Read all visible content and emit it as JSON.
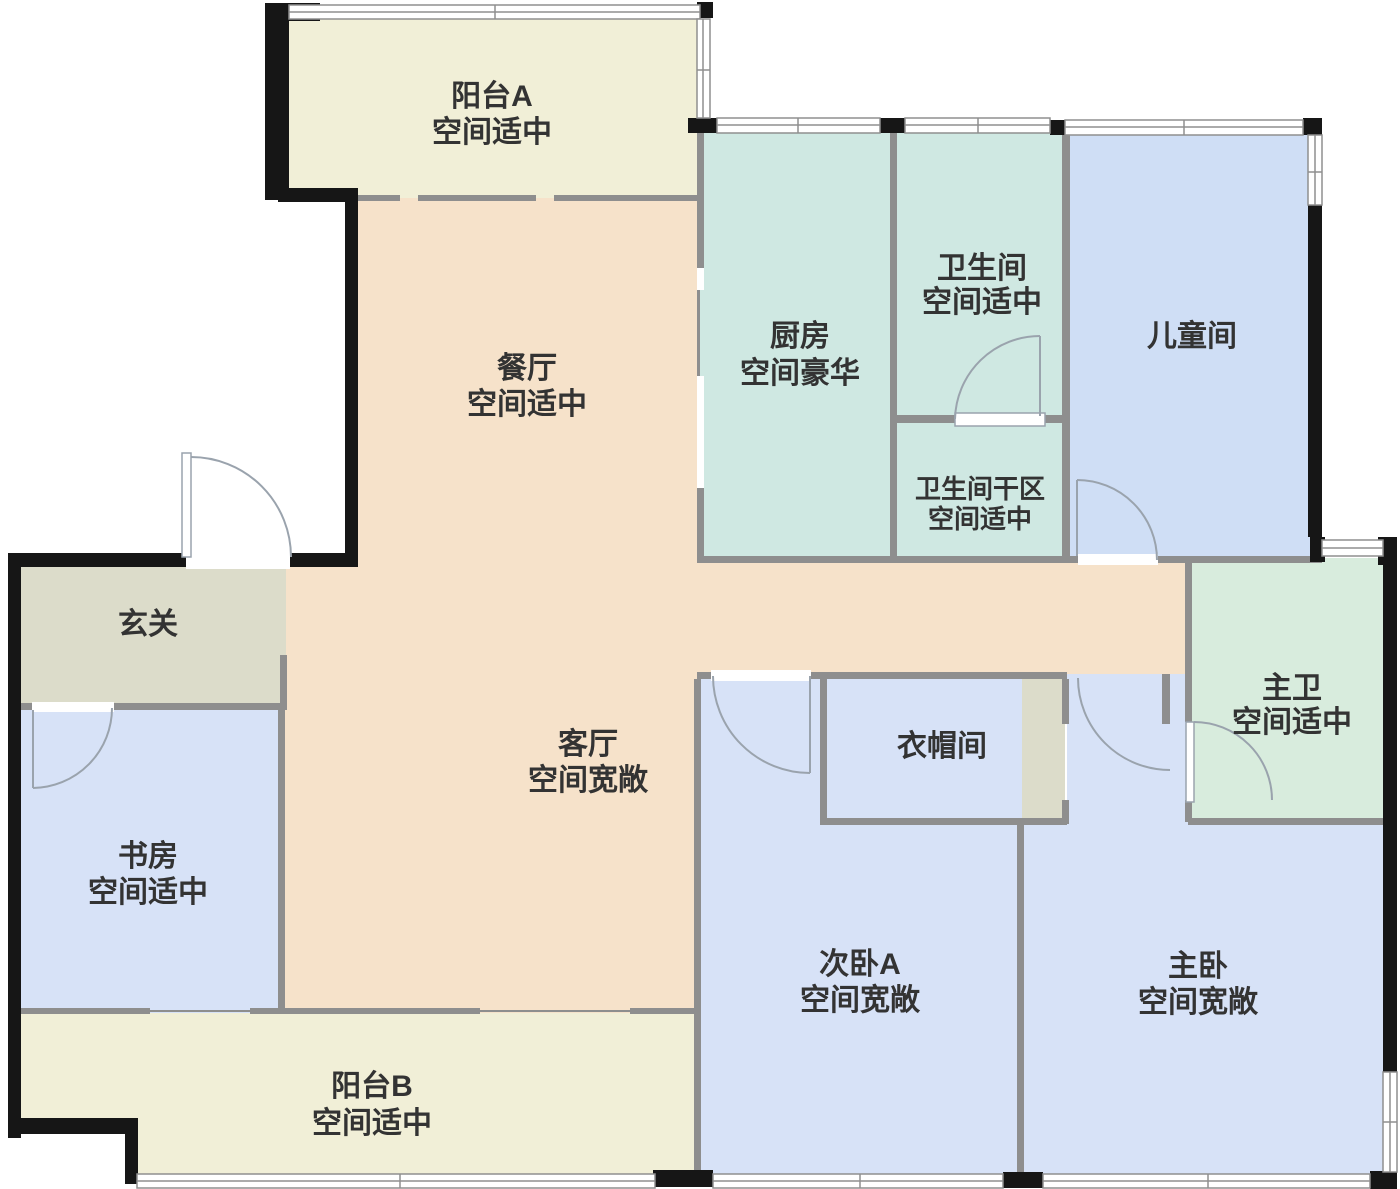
{
  "title": "floor-plan",
  "rooms": [
    {
      "id": "balcony-a",
      "name": "阳台A",
      "note": "空间适中"
    },
    {
      "id": "dining",
      "name": "餐厅",
      "note": "空间适中"
    },
    {
      "id": "kitchen",
      "name": "厨房",
      "note": "空间豪华"
    },
    {
      "id": "bathroom",
      "name": "卫生间",
      "note": "空间适中"
    },
    {
      "id": "kids-room",
      "name": "儿童间",
      "note": ""
    },
    {
      "id": "bathroom-dry",
      "name": "卫生间干区",
      "note": "空间适中"
    },
    {
      "id": "entry",
      "name": "玄关",
      "note": ""
    },
    {
      "id": "living",
      "name": "客厅",
      "note": "空间宽敞"
    },
    {
      "id": "master-bath",
      "name": "主卫",
      "note": "空间适中"
    },
    {
      "id": "study",
      "name": "书房",
      "note": "空间适中"
    },
    {
      "id": "cloakroom",
      "name": "衣帽间",
      "note": ""
    },
    {
      "id": "bedroom-a",
      "name": "次卧A",
      "note": "空间宽敞"
    },
    {
      "id": "master-bedroom",
      "name": "主卧",
      "note": "空间宽敞"
    },
    {
      "id": "balcony-b",
      "name": "阳台B",
      "note": "空间适中"
    }
  ],
  "colors": {
    "balcony": "#f1efd7",
    "living": "#f6e2ca",
    "kitchen": "#cfe8e2",
    "mint": "#d8ecdd",
    "bedroom": "#d7e2f7",
    "kids": "#cfdef5",
    "gray_room": "#dcdcca",
    "wall": "#8e8e8e",
    "exterior": "#161616",
    "window": "#8f8f8f",
    "door_arc": "#9aa3ad",
    "text": "#333333"
  }
}
